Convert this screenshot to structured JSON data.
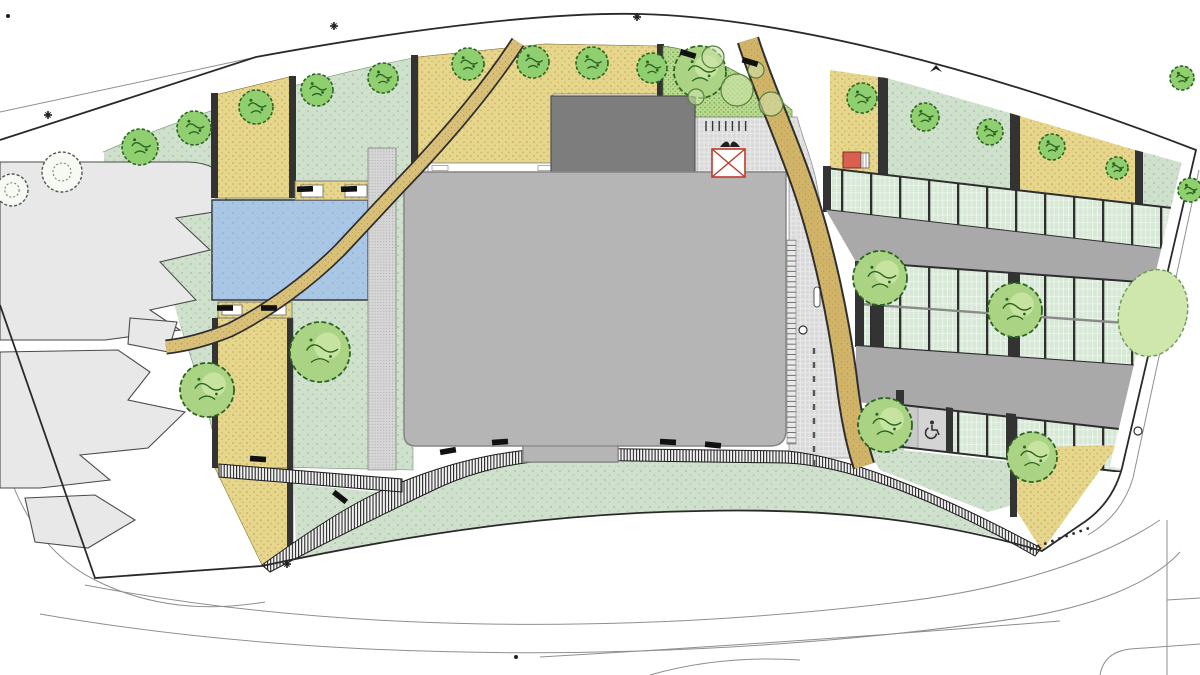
{
  "title": "Site plan drawing — curved landscaped plot with central building, pool, winding paths and permeable parking rows",
  "drawing_type": "architectural landscape site plan (no legible text labels in drawing)",
  "colors": {
    "paper": "#ffffff",
    "lawn": "#cfe0cc",
    "lawn_dot": "#9cbf9e",
    "planting_tan": "#e6d68c",
    "tan_dot": "#bd9f58",
    "ornamental_garden": "#b9da8e",
    "garden_dot": "#679a49",
    "pool_blue": "#a9c7e5",
    "pool_dot": "#84aed6",
    "gravel": "#d6d6d6",
    "plaza_paving": "#dcdcdc",
    "parking_stall": "#d7e8d6",
    "drive_aisle": "#a9a9a9",
    "building": "#b5b5b5",
    "roof_block": "#7d7d7d",
    "road_tan": "#d2b469",
    "footpath_tan": "#d9c078",
    "edge_bar": "#333333",
    "boundary_line": "#2a2a2a",
    "canopy_red": "#c0392b",
    "utility_red": "#d9604f",
    "tree_fill": "#8fcf6f",
    "tree_light_fill": "#abd384",
    "tree_stroke": "#2c6423",
    "hedge_fill": "#cfe6ad"
  },
  "areas": {
    "building": "large grey building, centre",
    "roof_block": "darker raised roof volume at building top-centre",
    "pool": "rectangular blue water feature, left of building",
    "ornamental_garden": "dense bright-green planted garden, north-east of building",
    "plaza": "fine-grid paved entrance court east of building",
    "road": "tan vehicular drive curving north–south through east side",
    "footpath": "narrow tan footpath winding from top across the pool to the west parcels",
    "boardwalk": "striped hatched walkway sweeping along the south side of the building",
    "parking": "three rows of permeable green parking stalls with grey drive aisles, east wedge",
    "neighbour_parcels": "light-grey jagged existing parcels, far west",
    "lawn": "sage-green stippled lawn areas",
    "planting_beds": "tan stippled planting beds with dark edge bars"
  },
  "landscape": {
    "trees_canopy": [
      [
        140,
        147,
        18
      ],
      [
        194,
        128,
        17
      ],
      [
        256,
        107,
        17
      ],
      [
        317,
        90,
        16
      ],
      [
        383,
        78,
        15
      ],
      [
        468,
        64,
        16
      ],
      [
        533,
        62,
        16
      ],
      [
        592,
        63,
        16
      ],
      [
        652,
        68,
        15
      ],
      [
        862,
        98,
        15
      ],
      [
        925,
        117,
        14
      ],
      [
        990,
        132,
        13
      ],
      [
        1052,
        147,
        13
      ],
      [
        1117,
        168,
        11
      ],
      [
        1190,
        190,
        12
      ],
      [
        1182,
        78,
        12
      ]
    ],
    "trees_large": [
      [
        320,
        352,
        30
      ],
      [
        207,
        390,
        27
      ],
      [
        700,
        72,
        26
      ],
      [
        880,
        278,
        27
      ],
      [
        1015,
        310,
        27
      ],
      [
        885,
        425,
        27
      ],
      [
        1032,
        457,
        25
      ]
    ],
    "trees_outline": [
      [
        62,
        172,
        20
      ],
      [
        12,
        190,
        16
      ]
    ],
    "shrub_circles": [
      [
        737,
        90,
        16
      ],
      [
        771,
        104,
        12
      ],
      [
        713,
        57,
        11
      ],
      [
        696,
        97,
        8
      ],
      [
        756,
        70,
        8
      ]
    ],
    "hedges": [
      [
        1153,
        313,
        34,
        44,
        15
      ]
    ]
  },
  "furniture": {
    "benches": [
      [
        305,
        189,
        -2
      ],
      [
        349,
        189,
        -2
      ],
      [
        225,
        308,
        0
      ],
      [
        269,
        308,
        0
      ],
      [
        448,
        451,
        -10
      ],
      [
        500,
        442,
        -4
      ],
      [
        668,
        442,
        3
      ],
      [
        713,
        445,
        6
      ],
      [
        258,
        459,
        4
      ],
      [
        340,
        497,
        38
      ],
      [
        688,
        54,
        17
      ],
      [
        750,
        62,
        17
      ]
    ],
    "bike_racks": {
      "x_start": 706,
      "x_end": 752,
      "step": 6.6,
      "y_top": 121,
      "y_bottom": 131
    }
  },
  "markers": {
    "survey_crosses": [
      [
        48,
        115
      ],
      [
        334,
        26
      ],
      [
        637,
        17
      ],
      [
        287,
        564
      ]
    ],
    "small_dots": [
      [
        516,
        657
      ],
      [
        8,
        16
      ]
    ],
    "circle_marks": [
      [
        1138,
        431
      ],
      [
        803,
        330
      ]
    ],
    "bird_mark": [
      936,
      69
    ]
  },
  "parking": {
    "row_count": 3,
    "stall_finish": "permeable green grid pavers",
    "accessible_stall": true,
    "accessible_symbol": "wheelchair"
  },
  "icons": {
    "wheelchair-icon": "accessible parking symbol",
    "red-x-canopy-icon": "red crossed square (canopy / skylight symbol)",
    "utility-box-icon": "small red utility cabinet",
    "survey-cross-icon": "boundary survey cross marks"
  }
}
